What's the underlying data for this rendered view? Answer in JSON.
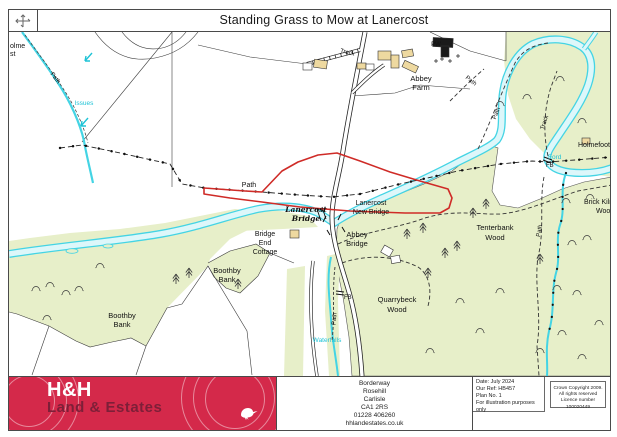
{
  "window": {
    "title": "Standing Grass to Mow at Lanercost"
  },
  "map": {
    "labels": {
      "fragment_top_left_1": "olme",
      "fragment_top_left_2": "st",
      "path_nw": "Path",
      "issues": "Issues",
      "track_top": "Track",
      "pw": "PW",
      "abbey_farm_1": "Abbey",
      "abbey_farm_2": "Farm",
      "path_ne1": "Path",
      "path_ne2": "Path",
      "track_ne": "Track",
      "holmefoot": "Holmefoot",
      "ford": "Ford",
      "fb_ne": "FB",
      "path_mid": "Path",
      "lanercost_bridge_1": "Lanercost",
      "lanercost_bridge_2": "Bridge",
      "lanercost_new_bridge_1": "Lanercost",
      "lanercost_new_bridge_2": "New Bridge",
      "abbey_bridge_1": "Abbey",
      "abbey_bridge_2": "Bridge",
      "bridge_end_cottage_1": "Bridge",
      "bridge_end_cottage_2": "End",
      "bridge_end_cottage_3": "Cottage",
      "boothby_bank_w_1": "Boothby",
      "boothby_bank_w_2": "Bank",
      "boothby_bank_e_1": "Boothby",
      "boothby_bank_e_2": "Bank",
      "tenterbank_wood_1": "Tenterbank",
      "tenterbank_wood_2": "Wood",
      "quarrybeck_wood_1": "Quarrybeck",
      "quarrybeck_wood_2": "Wood",
      "waterfalls": "Waterfalls",
      "fb_s": "FB",
      "path_s": "Path",
      "brick_kiln_1": "Brick Kiln",
      "brick_kiln_2": "Wood",
      "path_e": "Path"
    },
    "colors": {
      "sale_boundary_red": "#cf2b27",
      "water_cyan": "#44d4e4",
      "woodland_green": "#e7efc9",
      "building_tan": "#eed9a0"
    }
  },
  "footer": {
    "brand": {
      "name_top": "H&H",
      "name_bottom": "Land & Estates",
      "accent": "#d4294a"
    },
    "address_lines": [
      "Borderway",
      "Rosehill",
      "Carlisle",
      "CA1 2RS",
      "01228 406260",
      "hhlandestates.co.uk"
    ],
    "plan_info_lines": [
      "Date: July 2024",
      "Our Ref: HB457",
      "Plan No. 1",
      "For illustration purposes only"
    ],
    "copyright_lines": [
      "Crown Copyright 2009.",
      "All rights reserved",
      "Licence number 100020449"
    ]
  }
}
